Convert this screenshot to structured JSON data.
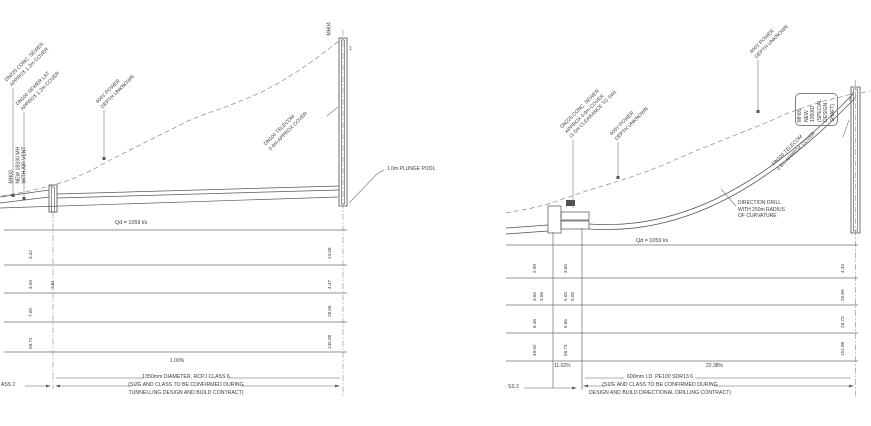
{
  "palette": {
    "ink": "#3c3c3c",
    "line": "#777777",
    "shaft": "#4f4f4f"
  },
  "left_profile": {
    "labels": {
      "utility_1": "DN225 CONC. SEWER\nAPPROX 1.2m COVER",
      "utility_2": "DN100 SEWER LAT\nAPPROX 1.2m COVER",
      "utility_3": "400V POWER\nDEPTH UNKNOWN",
      "utility_4": "DN100 TELECOM\n0.6m APPROX COVER",
      "mh_start": "MH03\nNEW 1B100 MH\nWITH AIR VENT",
      "mh_end": "MH04",
      "marker": "1",
      "plunge_pool": "1.0m PLUNGE POOL"
    },
    "flow": "Qd = 1059 l/s",
    "gradient": "1.00%",
    "pipe_spec": "1350mm DIAMETER, RCPJ CLASS 6\n(SIZE AND CLASS TO BE CONFIRMED DURING\nTUNNELLING DESIGN AND BUILD CONTRACT)",
    "class_label": "ASS 2",
    "levels": {
      "start_col": [
        "3.42",
        "3.59",
        "7.00",
        "58.72"
      ],
      "start_col_b": "3.61",
      "end_col": [
        "24.08",
        "4.47",
        "28.56",
        "145.08"
      ]
    }
  },
  "right_profile": {
    "labels": {
      "utility_1": "DN225 CONC. SEWER\nAPPROX 0.9m COVER\n(1.0m CLEARANCE TO SW)",
      "utility_2": "400V POWER\nDEPTH UNKNOWN",
      "utility_3": "400V POWER\nDEPTH UNKNOWN",
      "utility_4": "DN100 TELECOM\n0.6m APPROX COVER",
      "direction_drill": "DIRECTION DRILL\nWITH 250m RADIUS\nOF CURVATURE",
      "shaft": "MH05 NEW 1050ID\n(SPECIAL DESIGN SHAFT)"
    },
    "flow": "Qd = 1059 l/s",
    "gradients": [
      "11.02%",
      "22.38%"
    ],
    "pipe_spec": "600mm I.D. PE100 SDR13.6\n(SIZE AND CLASS TO BE CONFIRMED DURING\nDESIGN AND BUILD DIRECTIONAL DRILLING CONTRACT)",
    "class_label": "SS 2",
    "levels": {
      "col_a": [
        "2.99",
        "3.50",
        "6.48",
        "49.92"
      ],
      "col_a_b": "3.58",
      "col_b": [
        "3.65",
        "5.00",
        "6.65",
        "58.73"
      ],
      "col_b_b": "5.08",
      "col_c": [
        "4.43",
        "25.69",
        "28.73",
        "151.98"
      ]
    }
  }
}
